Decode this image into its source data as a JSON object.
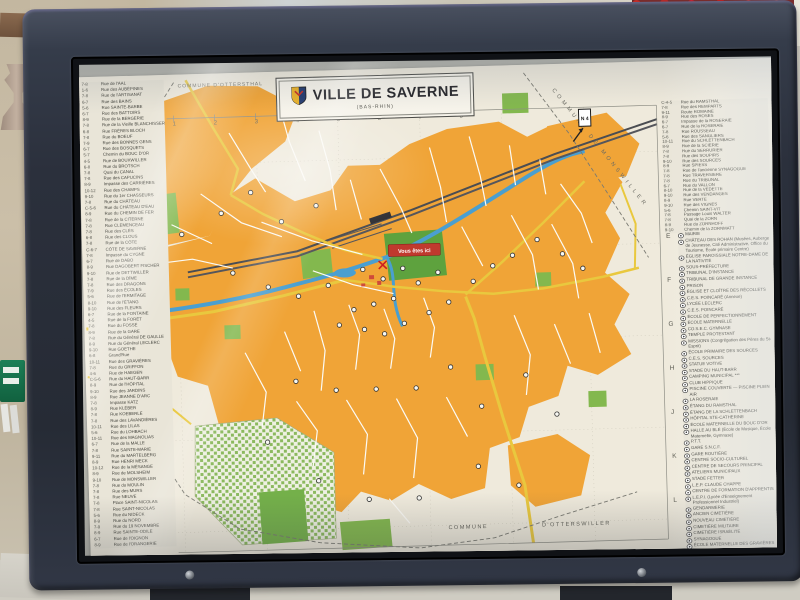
{
  "map": {
    "title": "VILLE DE SAVERNE",
    "subtitle": "(BAS-RHIN)",
    "you_are_here": "Vous êtes ici",
    "road_badge": "N 4",
    "boundaries": {
      "top_left": "COMMUNE D'OTTERSTHAL",
      "top_right": "COMMUNE  DE  MONSWILLER",
      "bottom_left_word": "COMMUNE",
      "bottom_right_word": "D'OTTERSWILLER"
    },
    "colors": {
      "urban": "#f0a437",
      "park": "#83b84e",
      "water": "#4a9fd0",
      "main_road": "#e9c83e",
      "rail": "#4b4d52",
      "marker_red": "#c0392e",
      "paper": "#e9e5d8"
    },
    "grid": {
      "cols": [
        "1",
        "2",
        "3",
        "4",
        "5",
        "6",
        "7",
        "8"
      ],
      "rows": [
        "E",
        "F",
        "G",
        "H",
        "J",
        "K",
        "L"
      ]
    },
    "street_index_left": [
      {
        "r": "7-8",
        "n": "Rue de l'AAL"
      },
      {
        "r": "1-6",
        "n": "Rue des AUBÉPINES"
      },
      {
        "r": "7-8",
        "n": "Rue de l'ARTISANAT"
      },
      {
        "r": "6-7",
        "n": "Rue des BAINS"
      },
      {
        "r": "5-6",
        "n": "Rue SAINTE-BARBE"
      },
      {
        "r": "6-7",
        "n": "Rue des BATTOIRS"
      },
      {
        "r": "8-9",
        "n": "Rue de la BERGERIE"
      },
      {
        "r": "7-8",
        "n": "Rue de la Vieille BLANCHISSERIE"
      },
      {
        "r": "6-8",
        "n": "Rue FRÈRES BLOCH"
      },
      {
        "r": "7-8",
        "n": "Rue du BOEUF"
      },
      {
        "r": "7-9",
        "n": "Rue des BONNES GENS"
      },
      {
        "r": "6-7",
        "n": "Rue des BOSQUETS"
      },
      {
        "r": "5-7",
        "n": "Chemin du BOUC D'OR"
      },
      {
        "r": "4-5",
        "n": "Rue de BOUXWILLER"
      },
      {
        "r": "6-8",
        "n": "Rue du BROTSCH"
      },
      {
        "r": "7-8",
        "n": "Quai du CANAL"
      },
      {
        "r": "7-8",
        "n": "Rue des CAPUCINS"
      },
      {
        "r": "8-9",
        "n": "Impasse des CARRIÈRES"
      },
      {
        "r": "10-12",
        "n": "Rue des CHAMPS"
      },
      {
        "r": "9-10",
        "n": "Rue du 1er CHASSEURS"
      },
      {
        "r": "7-8",
        "n": "Rue du CHÂTEAU"
      },
      {
        "r": "C-5-6",
        "n": "Rue du CHÂTEAU D'EAU"
      },
      {
        "r": "8-9",
        "n": "Rue du CHEMIN DE FER"
      },
      {
        "r": "7-8",
        "n": "Rue de la CITERNE"
      },
      {
        "r": "7-8",
        "n": "Rue CLEMENCEAU"
      },
      {
        "r": "7-8",
        "n": "Rue des CLÉS"
      },
      {
        "r": "6-8",
        "n": "Rue des CLOUS"
      },
      {
        "r": "7-8",
        "n": "Rue de la CÔTE"
      },
      {
        "r": "C-6-7",
        "n": "CÔTE DE SAVERNE"
      },
      {
        "r": "7-8",
        "n": "Impasse du CYGNE"
      },
      {
        "r": "6-7",
        "n": "Rue de DABO"
      },
      {
        "r": "8-9",
        "n": "Rue DAGOBERT FISCHER"
      },
      {
        "r": "9-10",
        "n": "Rue de DETTWILLER"
      },
      {
        "r": "7-8",
        "n": "Rue de la DÎME"
      },
      {
        "r": "7-8",
        "n": "Rue des DRAGONS"
      },
      {
        "r": "7-9",
        "n": "Rue des ÉCOLES"
      },
      {
        "r": "5-6",
        "n": "Rue de l'ERMITAGE"
      },
      {
        "r": "8-10",
        "n": "Rue de l'ÉTANG"
      },
      {
        "r": "9-10",
        "n": "Rue des FLEURS"
      },
      {
        "r": "6-7",
        "n": "Rue de la FONTAINE"
      },
      {
        "r": "4-5",
        "n": "Rue de la FORÊT"
      },
      {
        "r": "7-8",
        "n": "Rue du FOSSÉ"
      },
      {
        "r": "8-9",
        "n": "Rue de la GARE"
      },
      {
        "r": "7-8",
        "n": "Rue du Général DE GAULLE"
      },
      {
        "r": "8-9",
        "n": "Rue du Général LECLERC"
      },
      {
        "r": "9-10",
        "n": "Rue GOETHE"
      },
      {
        "r": "6-8",
        "n": "Grand'Rue"
      },
      {
        "r": "10-11",
        "n": "Rue des GRAVIÈRES"
      },
      {
        "r": "7-8",
        "n": "Rue du GRIFFON"
      },
      {
        "r": "4-6",
        "n": "Rue de HAEGEN"
      },
      {
        "r": "C-5-6",
        "n": "Rue du HAUT-BARR"
      },
      {
        "r": "8-9",
        "n": "Rue de l'HÔPITAL"
      },
      {
        "r": "9-10",
        "n": "Rue des JARDINS"
      },
      {
        "r": "8-9",
        "n": "Rue JEANNE D'ARC"
      },
      {
        "r": "7-8",
        "n": "Impasse KATZ"
      },
      {
        "r": "8-9",
        "n": "Rue KLÉBER"
      },
      {
        "r": "7-8",
        "n": "Rue KOEBERLÉ"
      },
      {
        "r": "7-8",
        "n": "Rue des LAVANDIÈRES"
      },
      {
        "r": "10-11",
        "n": "Rue des LILAS"
      },
      {
        "r": "5-6",
        "n": "Rue du LOHBACH"
      },
      {
        "r": "10-11",
        "n": "Rue des MAGNOLIAS"
      },
      {
        "r": "6-7",
        "n": "Rue de la MALLE"
      },
      {
        "r": "7-8",
        "n": "Rue SAINTE-MARIE"
      },
      {
        "r": "9-11",
        "n": "Rue du MARTELBERG"
      },
      {
        "r": "8-9",
        "n": "Rue HENRI MECK"
      },
      {
        "r": "10-12",
        "n": "Rue de la MÉSANGE"
      },
      {
        "r": "8-9",
        "n": "Rue de MOLSHEIM"
      },
      {
        "r": "9-10",
        "n": "Rue de MONSWILLER"
      },
      {
        "r": "7-8",
        "n": "Rue du MOULIN"
      },
      {
        "r": "7-8",
        "n": "Rue des MURS"
      },
      {
        "r": "7-8",
        "n": "Rue NEUVE"
      },
      {
        "r": "7-8",
        "n": "Place SAINT-NICOLAS"
      },
      {
        "r": "7-8",
        "n": "Rue SAINT-NICOLAS"
      },
      {
        "r": "5-6",
        "n": "Rue du NIDECK"
      },
      {
        "r": "8-9",
        "n": "Rue du NORD"
      },
      {
        "r": "7-9",
        "n": "Rue du 19 NOVEMBRE"
      },
      {
        "r": "8-9",
        "n": "Rue SAINTE-ODILE"
      },
      {
        "r": "6-7",
        "n": "Rue de l'OIGNON"
      },
      {
        "r": "8-9",
        "n": "Rue de l'ORANGERIE"
      }
    ],
    "street_index_right": [
      {
        "r": "C-4-5",
        "n": "Rue du RAMSTHAL"
      },
      {
        "r": "7-8",
        "n": "Rue des REMPARTS"
      },
      {
        "r": "9-11",
        "n": "Route ROMAINE"
      },
      {
        "r": "8-9",
        "n": "Rue des ROSES"
      },
      {
        "r": "6-7",
        "n": "Impasse de la ROSERAIE"
      },
      {
        "r": "6-7",
        "n": "Rue de la ROSERAIE"
      },
      {
        "r": "7-8",
        "n": "Rue ROUSSEAU"
      },
      {
        "r": "5-6",
        "n": "Rue des SANGLIERS"
      },
      {
        "r": "10-11",
        "n": "Rue du SCHLETTENBACH"
      },
      {
        "r": "8-9",
        "n": "Rue de la SCIERIE"
      },
      {
        "r": "7-8",
        "n": "Rue du SERRURIER"
      },
      {
        "r": "7-8",
        "n": "Rue des SOUPIRS"
      },
      {
        "r": "9-10",
        "n": "Rue des SOURCES"
      },
      {
        "r": "8-9",
        "n": "Rue SPIESS"
      },
      {
        "r": "7-8",
        "n": "Rue de l'ancienne SYNAGOGUE"
      },
      {
        "r": "7-8",
        "n": "Rue TRAVERSIÈRE"
      },
      {
        "r": "7-8",
        "n": "Rue du TRIBUNAL"
      },
      {
        "r": "6-7",
        "n": "Rue du VALLON"
      },
      {
        "r": "8-10",
        "n": "Rue de la VEDETTE"
      },
      {
        "r": "9-10",
        "n": "Rue des VENDANGES"
      },
      {
        "r": "8-9",
        "n": "Rue VERTE"
      },
      {
        "r": "9-10",
        "n": "Rue des VIGNES"
      },
      {
        "r": "5-6",
        "n": "Chemin SAINT-VIT"
      },
      {
        "r": "7-8",
        "n": "Passage Louis WALTER"
      },
      {
        "r": "7-8",
        "n": "Quai de la ZORN"
      },
      {
        "r": "8-9",
        "n": "Rue du ZORNHOFF"
      },
      {
        "r": "9-10",
        "n": "Chemin de la ZORNMATT"
      }
    ],
    "legend": [
      {
        "num": "1",
        "label": "MAIRIE"
      },
      {
        "num": "2",
        "label": "CHÂTEAU DES ROHAN (Musées, Auberge de Jeunesse, Cité Administrative, Office du Tourisme, École primaire Centre)"
      },
      {
        "num": "3",
        "label": "ÉGLISE PAROISSIALE NOTRE-DAME DE LA NATIVITÉ"
      },
      {
        "num": "4",
        "label": "SOUS-PRÉFECTURE"
      },
      {
        "num": "5",
        "label": "TRIBUNAL D'INSTANCE"
      },
      {
        "num": "6",
        "label": "TRIBUNAL DE GRANDE INSTANCE"
      },
      {
        "num": "7",
        "label": "PRISON"
      },
      {
        "num": "8",
        "label": "ÉGLISE ET CLOÎTRE DES RÉCOLLETS"
      },
      {
        "num": "9",
        "label": "C.E.S. POINCARÉ (Annexe)"
      },
      {
        "num": "10",
        "label": "LYCÉE LECLERC"
      },
      {
        "num": "11",
        "label": "C.E.S. POINCARÉ"
      },
      {
        "num": "12",
        "label": "ÉCOLE DE PERFECTIONNEMENT"
      },
      {
        "num": "13",
        "label": "ÉCOLE MATERNELLE"
      },
      {
        "num": "14",
        "label": "CO.S.E.C. GYMNASE"
      },
      {
        "num": "15",
        "label": "TEMPLE PROTESTANT"
      },
      {
        "num": "16",
        "label": "MISSIONS (Congrégation des Pères du St-Esprit)"
      },
      {
        "num": "17",
        "label": "ÉCOLE PRIMAIRE DES SOURCES"
      },
      {
        "num": "18",
        "label": "C.E.S. SOURCES"
      },
      {
        "num": "19",
        "label": "STATUE VOTIVE"
      },
      {
        "num": "20",
        "label": "STADE DU HAUT-BARR"
      },
      {
        "num": "21",
        "label": "CAMPING MUNICIPAL ***"
      },
      {
        "num": "22",
        "label": "CLUB HIPPIQUE"
      },
      {
        "num": "23",
        "label": "PISCINE COUVERTE — PISCINE PLEIN AIR"
      },
      {
        "num": "24",
        "label": "LA ROSERAIE"
      },
      {
        "num": "25",
        "label": "ÉTANG DU RAMSTHAL"
      },
      {
        "num": "26",
        "label": "ÉTANG DE LA SCHLETTENBACH"
      },
      {
        "num": "27",
        "label": "HÔPITAL STE-CATHERINE"
      },
      {
        "num": "28",
        "label": "ÉCOLE MATERNELLE DU BOUC D'OR"
      },
      {
        "num": "29",
        "label": "HALLE AU BLÉ (École de Musique, École Maternelle, Gymnase)"
      },
      {
        "num": "30",
        "label": "P.T.T."
      },
      {
        "num": "31",
        "label": "GARE S.N.C.F."
      },
      {
        "num": "32",
        "label": "GARE ROUTIÈRE"
      },
      {
        "num": "33",
        "label": "CENTRE SOCIO-CULTUREL"
      },
      {
        "num": "34",
        "label": "CENTRE DE SECOURS PRINCIPAL"
      },
      {
        "num": "35",
        "label": "ATELIERS MUNICIPAUX"
      },
      {
        "num": "36",
        "label": "STADE FETTER"
      },
      {
        "num": "37",
        "label": "L.E.P. CLAUDE CHAPPE"
      },
      {
        "num": "38",
        "label": "CENTRE DE FORMATION D'APPRENTIS"
      },
      {
        "num": "39",
        "label": "L.E.P.I. (Lycée d'Enseignement Professionnel Industriel)"
      },
      {
        "num": "40",
        "label": "GENDARMERIE"
      },
      {
        "num": "41",
        "label": "ANCIEN CIMETIÈRE"
      },
      {
        "num": "42",
        "label": "NOUVEAU CIMETIÈRE"
      },
      {
        "num": "43",
        "label": "CIMETIÈRE MILITAIRE"
      },
      {
        "num": "44",
        "label": "CIMETIÈRE ISRAÉLITE"
      },
      {
        "num": "45",
        "label": "SYNAGOGUE"
      },
      {
        "num": "46",
        "label": "ÉCOLE MATERNELLE DES GRAVIÈRES"
      },
      {
        "num": "47",
        "label": "CHAMP DE FOIRE"
      },
      {
        "num": "48",
        "label": "PORT DE PLAISANCE"
      },
      {
        "num": "49",
        "label": "I.M.P. LE ROSIER BLANC"
      },
      {
        "num": "50",
        "label": "SECTEUR PIÉTONNIER"
      },
      {
        "num": "51",
        "label": "JARDIN BOTANIQUE"
      }
    ]
  }
}
